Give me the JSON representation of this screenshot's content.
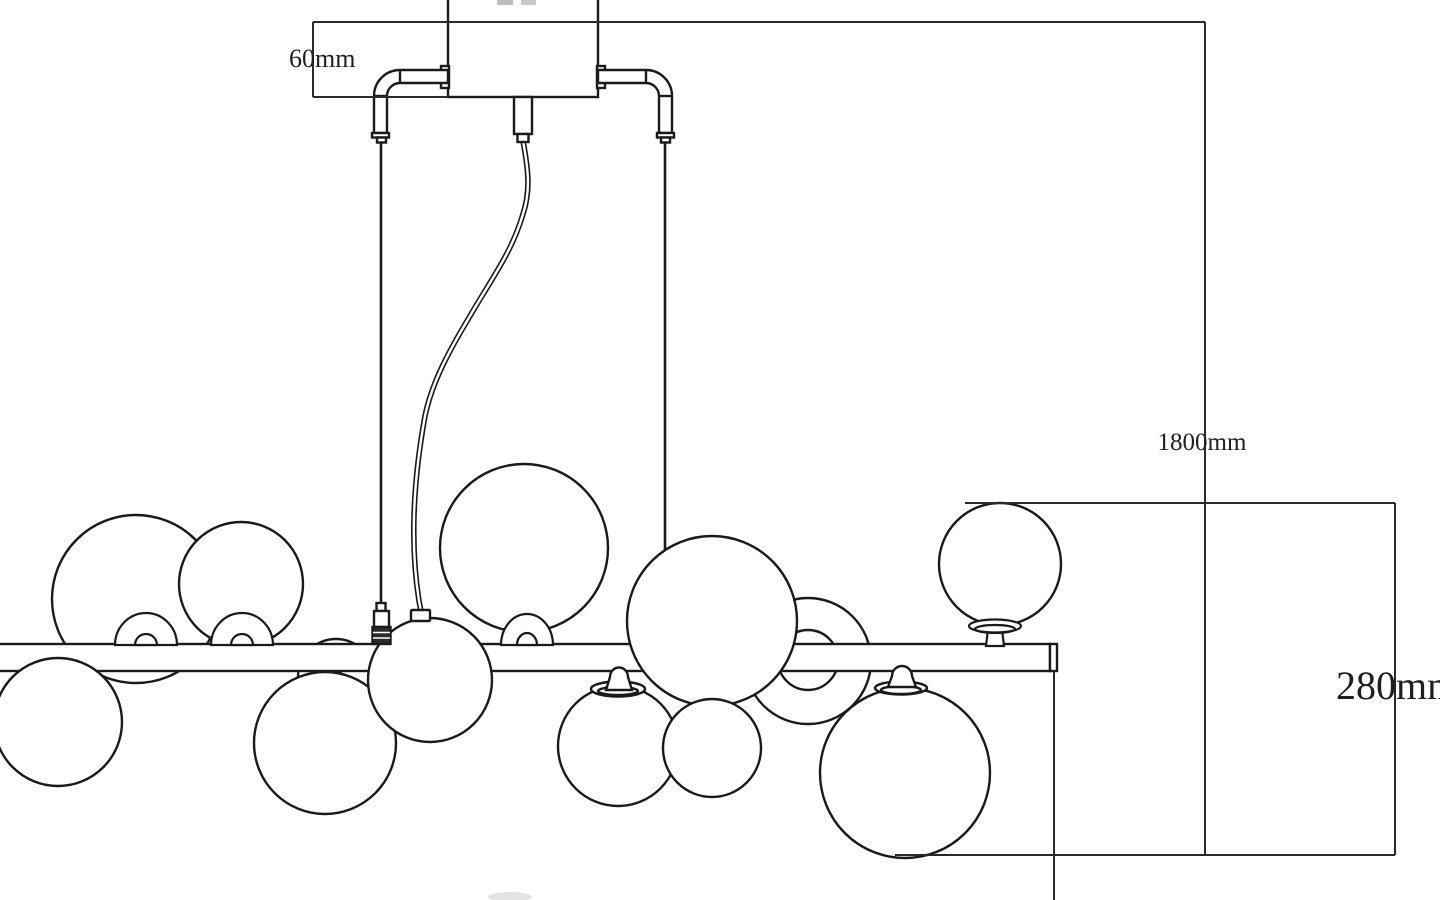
{
  "page": {
    "background": "#ffffff",
    "kind": "technical-dimension-drawing",
    "subject": "linear multi-globe chandelier line drawing"
  },
  "drawing": {
    "line_color": "#1a1a1a",
    "dimension_line_color": "#2a2a2a",
    "dimensions": {
      "canopy_height": {
        "label": "60mm"
      },
      "overall_drop": {
        "label": "1800mm"
      },
      "fixture_height": {
        "label": "280mm"
      }
    }
  }
}
